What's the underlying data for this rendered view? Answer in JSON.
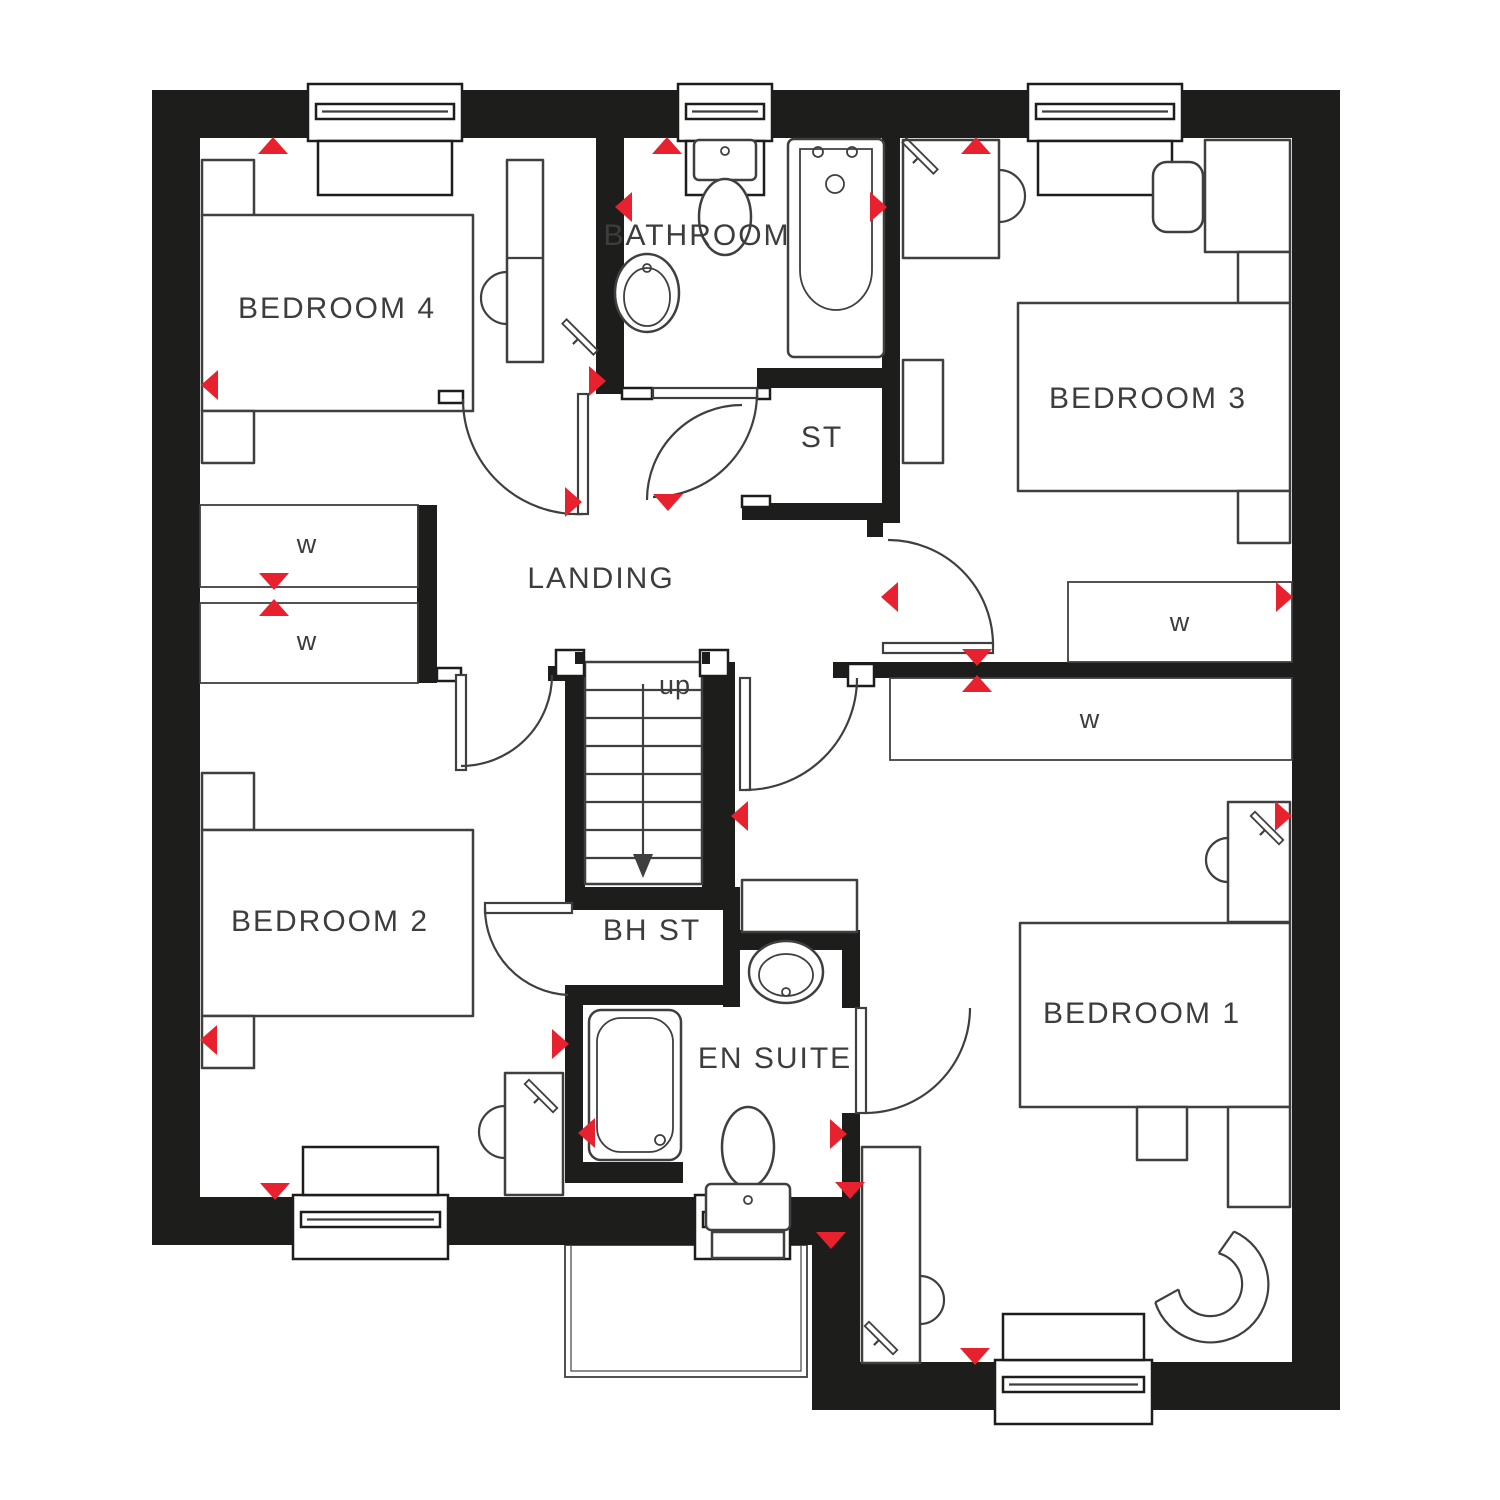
{
  "rooms": {
    "bedroom4": "BEDROOM 4",
    "bathroom": "BATHROOM",
    "bedroom3": "BEDROOM 3",
    "storage": "ST",
    "landing": "LANDING",
    "bedroom2": "BEDROOM 2",
    "bulkhead_store": "BH ST",
    "ensuite": "EN SUITE",
    "bedroom1": "BEDROOM 1"
  },
  "stairs": {
    "direction": "up"
  },
  "wardrobe": "w",
  "colors": {
    "wall": "#1d1d1b",
    "furniture_line": "#3f3f3f",
    "marker_red": "#e8212e",
    "label_text": "#3d3d3d",
    "background": "#ffffff"
  }
}
